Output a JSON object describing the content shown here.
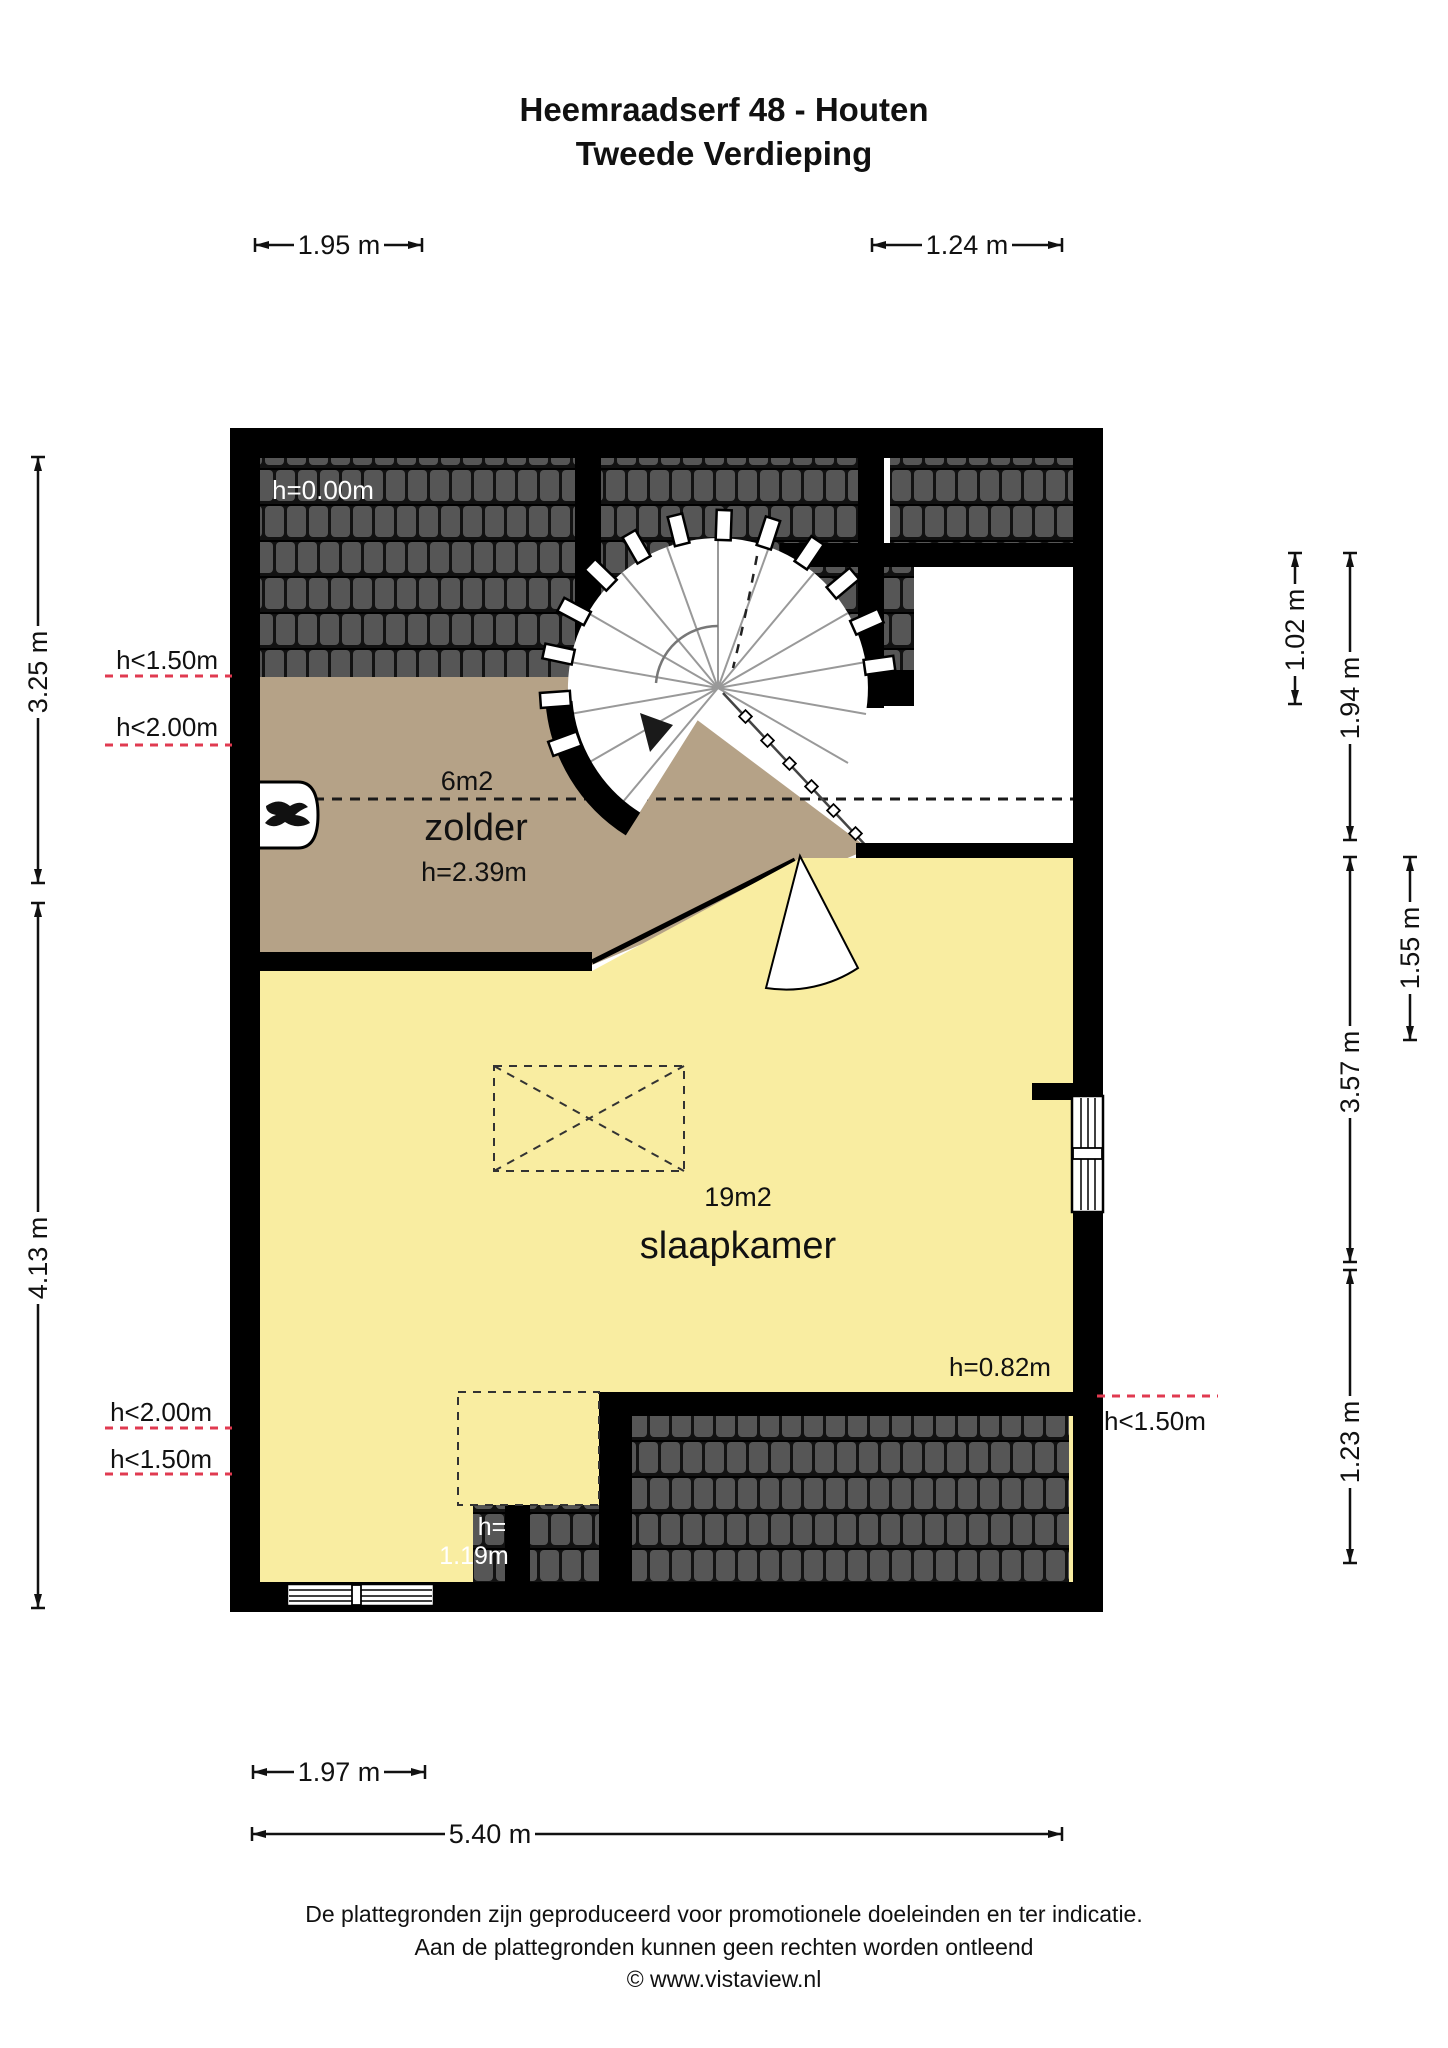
{
  "title": {
    "line1": "Heemraadserf 48 - Houten",
    "line2": "Tweede Verdieping"
  },
  "rooms": {
    "zolder": {
      "name": "zolder",
      "area": "6m2",
      "ceiling_height": "h=2.39m"
    },
    "slaapkamer": {
      "name": "slaapkamer",
      "area": "19m2"
    }
  },
  "annotations": {
    "roof_top": "h=0.00m",
    "left_upper_1": "h<1.50m",
    "left_upper_2": "h<2.00m",
    "left_lower_1": "h<2.00m",
    "left_lower_2": "h<1.50m",
    "right_lower": "h<1.50m",
    "knee_wall": "h=0.82m",
    "closet_line1": "h=",
    "closet_line2": "1.19m"
  },
  "dimensions": {
    "top": [
      "1.95 m",
      "1.24 m"
    ],
    "left": [
      "3.25 m",
      "4.13 m"
    ],
    "right": [
      "1.02 m",
      "1.94 m",
      "1.55 m",
      "3.57 m",
      "1.23 m"
    ],
    "bottom": [
      "1.97 m",
      "5.40 m"
    ]
  },
  "footer": {
    "line1": "De plattegronden zijn geproduceerd voor promotionele doeleinden en ter indicatie.",
    "line2": "Aan de plattegronden kunnen geen rechten worden ontleend",
    "line3": "© www.vistaview.nl"
  },
  "colors": {
    "wall": "#000000",
    "roof_tile": "#565656",
    "roof_background": "#121212",
    "zolder_floor": "#b5a287",
    "slaapkamer_floor": "#f9eda1",
    "height_contour_line": "#e03a50",
    "roof_label_text": "#ffffff"
  }
}
